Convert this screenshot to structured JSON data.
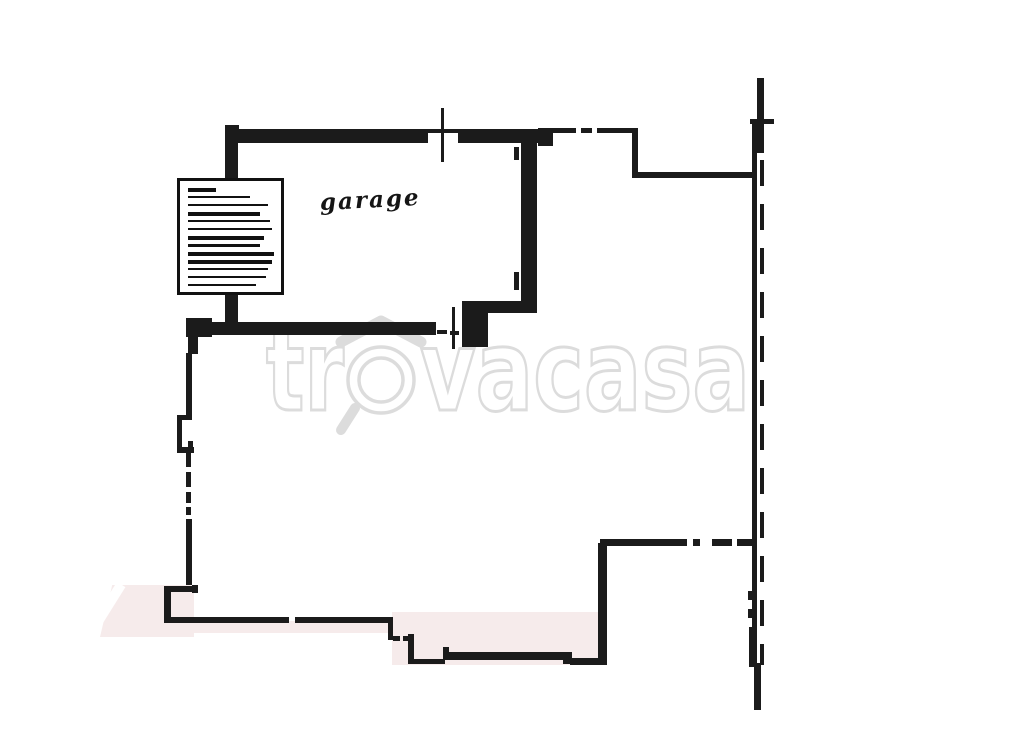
{
  "plan": {
    "room_label": "garage",
    "watermark": {
      "text": "trovacasa",
      "part1": "tr",
      "part2": "vacasa"
    },
    "colors": {
      "wall": "#1b1b1b",
      "floor_highlight": "#f6ebeb",
      "watermark_gray": "#dcdcdc",
      "background": "#ffffff"
    }
  }
}
